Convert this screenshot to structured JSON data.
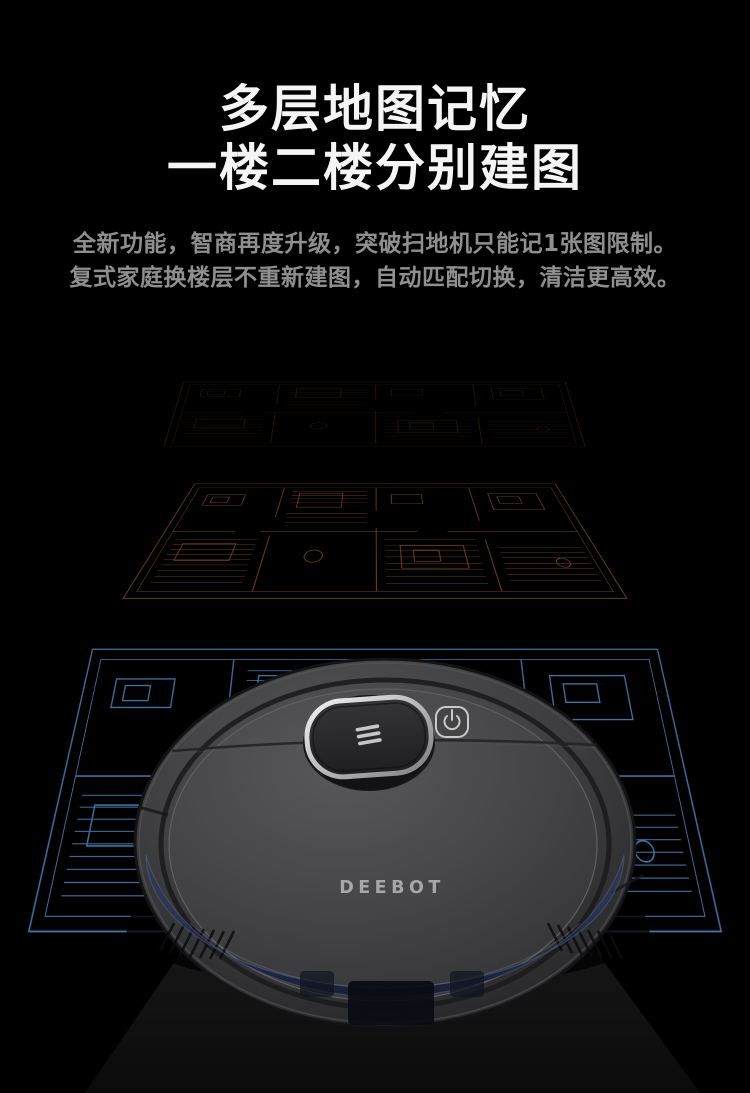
{
  "background_color": "#000000",
  "hero": {
    "title_line1": "多层地图记忆",
    "title_line2": "一楼二楼分别建图",
    "title_color": "#f5f5f5",
    "subtitle_line1": "全新功能，智商再度升级，突破扫地机只能记1张图限制。",
    "subtitle_line2": "复式家庭换楼层不重新建图，自动匹配切换，清洁更高效。",
    "subtitle_color": "#8f8f8f"
  },
  "floor_maps": {
    "layers": [
      {
        "label": "upper-floor-map-faint",
        "line_color": "#281708"
      },
      {
        "label": "middle-floor-map-orange",
        "line_color": "#6f4012"
      },
      {
        "label": "ground-floor-map-blue",
        "line_color": "#3e74a4"
      }
    ]
  },
  "robot": {
    "brand_label": "DEEBOT",
    "brand_color": "#b2b2b2",
    "body_color": "#3f3f41",
    "tank_color": "#2b3a63",
    "icons": {
      "turret_mark": "three-bars",
      "power_button": "power"
    }
  }
}
